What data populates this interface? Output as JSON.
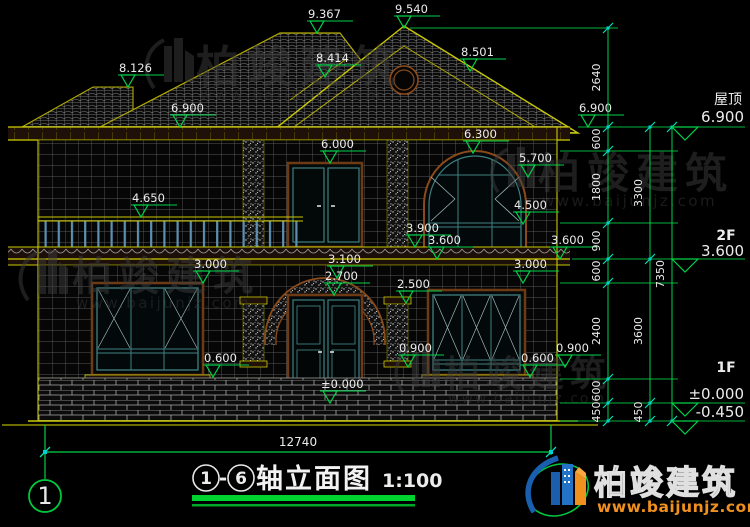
{
  "drawing": {
    "elevation_markers": [
      {
        "value": "8.126",
        "x": 128,
        "y": 87
      },
      {
        "value": "9.367",
        "x": 317,
        "y": 33
      },
      {
        "value": "9.540",
        "x": 404,
        "y": 28
      },
      {
        "value": "8.414",
        "x": 325,
        "y": 77
      },
      {
        "value": "8.501",
        "x": 470,
        "y": 71
      },
      {
        "value": "6.900",
        "x": 180,
        "y": 127
      },
      {
        "value": "6.900",
        "x": 588,
        "y": 127
      },
      {
        "value": "6.000",
        "x": 330,
        "y": 163
      },
      {
        "value": "6.300",
        "x": 473,
        "y": 153
      },
      {
        "value": "5.700",
        "x": 528,
        "y": 177
      },
      {
        "value": "4.650",
        "x": 141,
        "y": 217
      },
      {
        "value": "4.500",
        "x": 523,
        "y": 224
      },
      {
        "value": "3.900",
        "x": 415,
        "y": 247
      },
      {
        "value": "3.600",
        "x": 437,
        "y": 259
      },
      {
        "value": "3.600",
        "x": 560,
        "y": 259
      },
      {
        "value": "3.000",
        "x": 203,
        "y": 283
      },
      {
        "value": "3.000",
        "x": 523,
        "y": 283
      },
      {
        "value": "3.100",
        "x": 337,
        "y": 278
      },
      {
        "value": "2.700",
        "x": 334,
        "y": 295
      },
      {
        "value": "2.500",
        "x": 406,
        "y": 303
      },
      {
        "value": "0.900",
        "x": 408,
        "y": 367
      },
      {
        "value": "0.900",
        "x": 565,
        "y": 367
      },
      {
        "value": "0.600",
        "x": 213,
        "y": 377
      },
      {
        "value": "0.600",
        "x": 530,
        "y": 377
      },
      {
        "value": "±0.000",
        "x": 330,
        "y": 403
      }
    ],
    "dim_chains": [
      {
        "x": 608,
        "lx": 600,
        "segs": [
          {
            "t": "2640",
            "y1": 28,
            "y2": 127
          },
          {
            "t": "600",
            "y1": 127,
            "y2": 151
          },
          {
            "t": "1800",
            "y1": 151,
            "y2": 223
          },
          {
            "t": "900",
            "y1": 223,
            "y2": 259
          },
          {
            "t": "600",
            "y1": 259,
            "y2": 283
          },
          {
            "t": "2400",
            "y1": 283,
            "y2": 379
          },
          {
            "t": "600",
            "y1": 379,
            "y2": 403
          },
          {
            "t": "450",
            "y1": 403,
            "y2": 421
          }
        ]
      },
      {
        "x": 650,
        "lx": 642,
        "segs": [
          {
            "t": "3300",
            "y1": 127,
            "y2": 259
          },
          {
            "t": "3600",
            "y1": 259,
            "y2": 403
          },
          {
            "t": "450",
            "y1": 403,
            "y2": 421
          }
        ]
      },
      {
        "x": 672,
        "lx": 664,
        "segs": [
          {
            "t": "7350",
            "y1": 127,
            "y2": 421
          }
        ]
      }
    ],
    "bottom_dim": {
      "text": "12740"
    },
    "right_levels": {
      "roof": {
        "label": "屋顶",
        "value": "6.900"
      },
      "f2": {
        "label": "2F",
        "value": "3.600"
      },
      "f1": {
        "label": "1F",
        "value": "±0.000",
        "below": "-0.450"
      }
    },
    "axis_bubble": {
      "number": "1"
    }
  },
  "title": {
    "circle_start": "1",
    "separator": "-",
    "circle_end": "6",
    "text": "轴立面图",
    "scale": "1:100"
  },
  "watermark": {
    "name": "柏竣建筑",
    "url": "www.baijunjz.com"
  },
  "logo": {
    "name": "柏竣建筑",
    "url": "www.baijunjz.com"
  },
  "colors": {
    "background": "#000000",
    "cad_yellow": "#c9c900",
    "cad_olive": "#8f8f00",
    "dim_green": "#00d24a",
    "tick_cyan": "#00e0b0",
    "text_white": "#ececec",
    "frame_brown": "#8a4a1a",
    "frame_teal": "#3f8080",
    "rail_blue": "#5d8fb0",
    "band_dark": "#20100a",
    "logo_blue": "#1a5fae",
    "logo_orange": "#f0901e",
    "watermark_gray": "#3c3c3c"
  }
}
